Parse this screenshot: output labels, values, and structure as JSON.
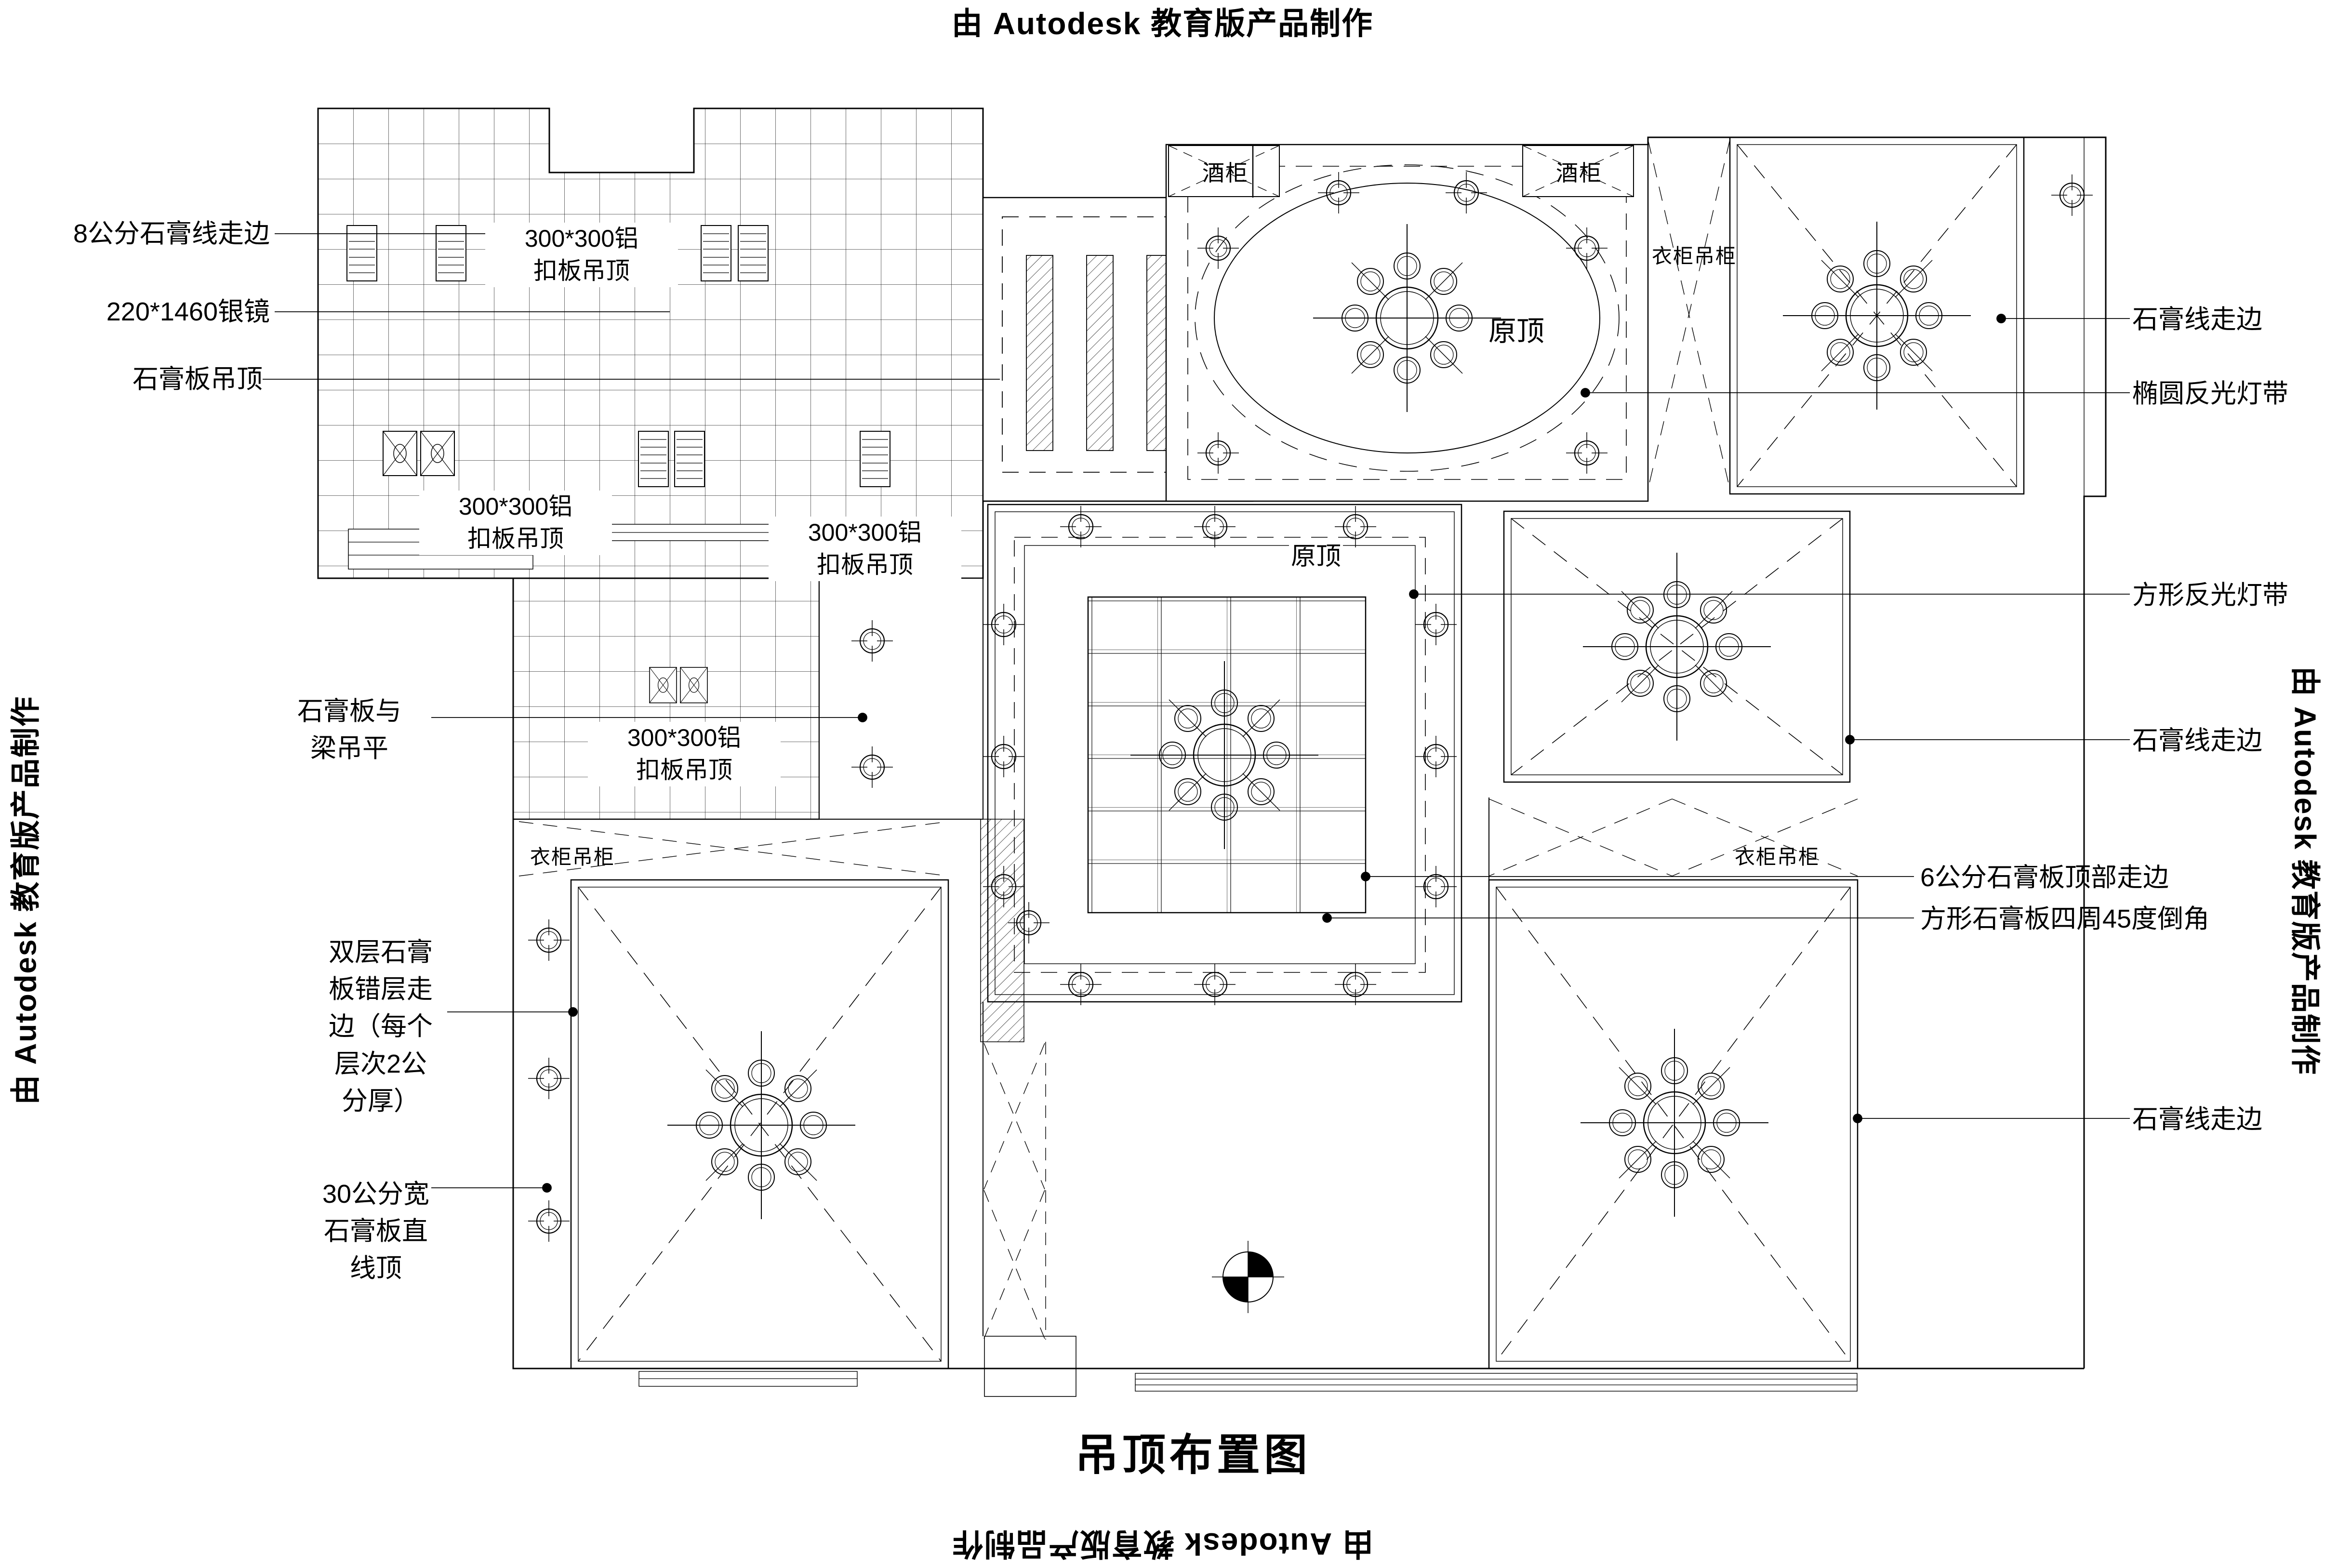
{
  "banners": {
    "top": "由 Autodesk 教育版产品制作",
    "bottom": "由 Autodesk 教育版产品制作",
    "left": "由 Autodesk 教育版产品制作",
    "right": "由 Autodesk 教育版产品制作"
  },
  "title": "吊顶布置图",
  "annotations_left": [
    {
      "text": "8公分石膏线走边"
    },
    {
      "text": "220*1460银镜"
    },
    {
      "text": "石膏板吊顶"
    },
    {
      "text": "石膏板与\n梁吊平"
    },
    {
      "text": "双层石膏\n板错层走\n边（每个\n层次2公\n分厚）"
    },
    {
      "text": "30公分宽\n石膏板直\n线顶"
    }
  ],
  "annotations_right": [
    {
      "text": "石膏线走边"
    },
    {
      "text": "椭圆反光灯带"
    },
    {
      "text": "方形反光灯带"
    },
    {
      "text": "石膏线走边"
    },
    {
      "text": "6公分石膏板顶部走边"
    },
    {
      "text": "方形石膏板四周45度倒角"
    },
    {
      "text": "石膏线走边"
    }
  ],
  "ceiling_labels": {
    "aluminum_panel": "300*300铝\n扣板吊顶",
    "original_ceiling": "原顶",
    "wine_cabinet": "酒柜",
    "wardrobe": "衣柜吊柜"
  },
  "colors": {
    "line": "#000000",
    "background": "#ffffff"
  }
}
